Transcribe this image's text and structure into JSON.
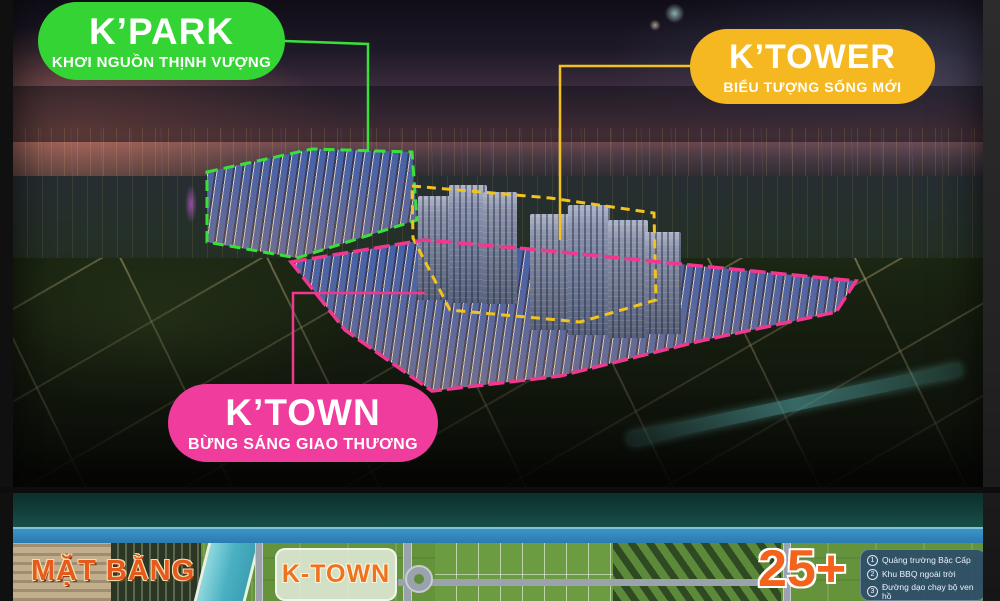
{
  "zones": {
    "kpark": {
      "title": "K’PARK",
      "subtitle": "KHƠI NGUỒN THỊNH VƯỢNG",
      "color": "#35d435"
    },
    "ktower": {
      "title": "K’TOWER",
      "subtitle": "BIỂU TƯỢNG SỐNG MỚI",
      "color": "#f5b821"
    },
    "ktown": {
      "title": "K’TOWN",
      "subtitle": "BỪNG SÁNG GIAO THƯƠNG",
      "color": "#f03c9c"
    }
  },
  "masterplan": {
    "title": "MẶT BẰNG",
    "area_label": "K-TOWN",
    "stat": "25+",
    "stat_color": "#f4631c",
    "legend": [
      {
        "num": "1",
        "label": "Quảng trường Bậc Cấp"
      },
      {
        "num": "2",
        "label": "Khu BBQ ngoài trời"
      },
      {
        "num": "3",
        "label": "Đường dạo chạy bộ ven hồ"
      }
    ]
  }
}
